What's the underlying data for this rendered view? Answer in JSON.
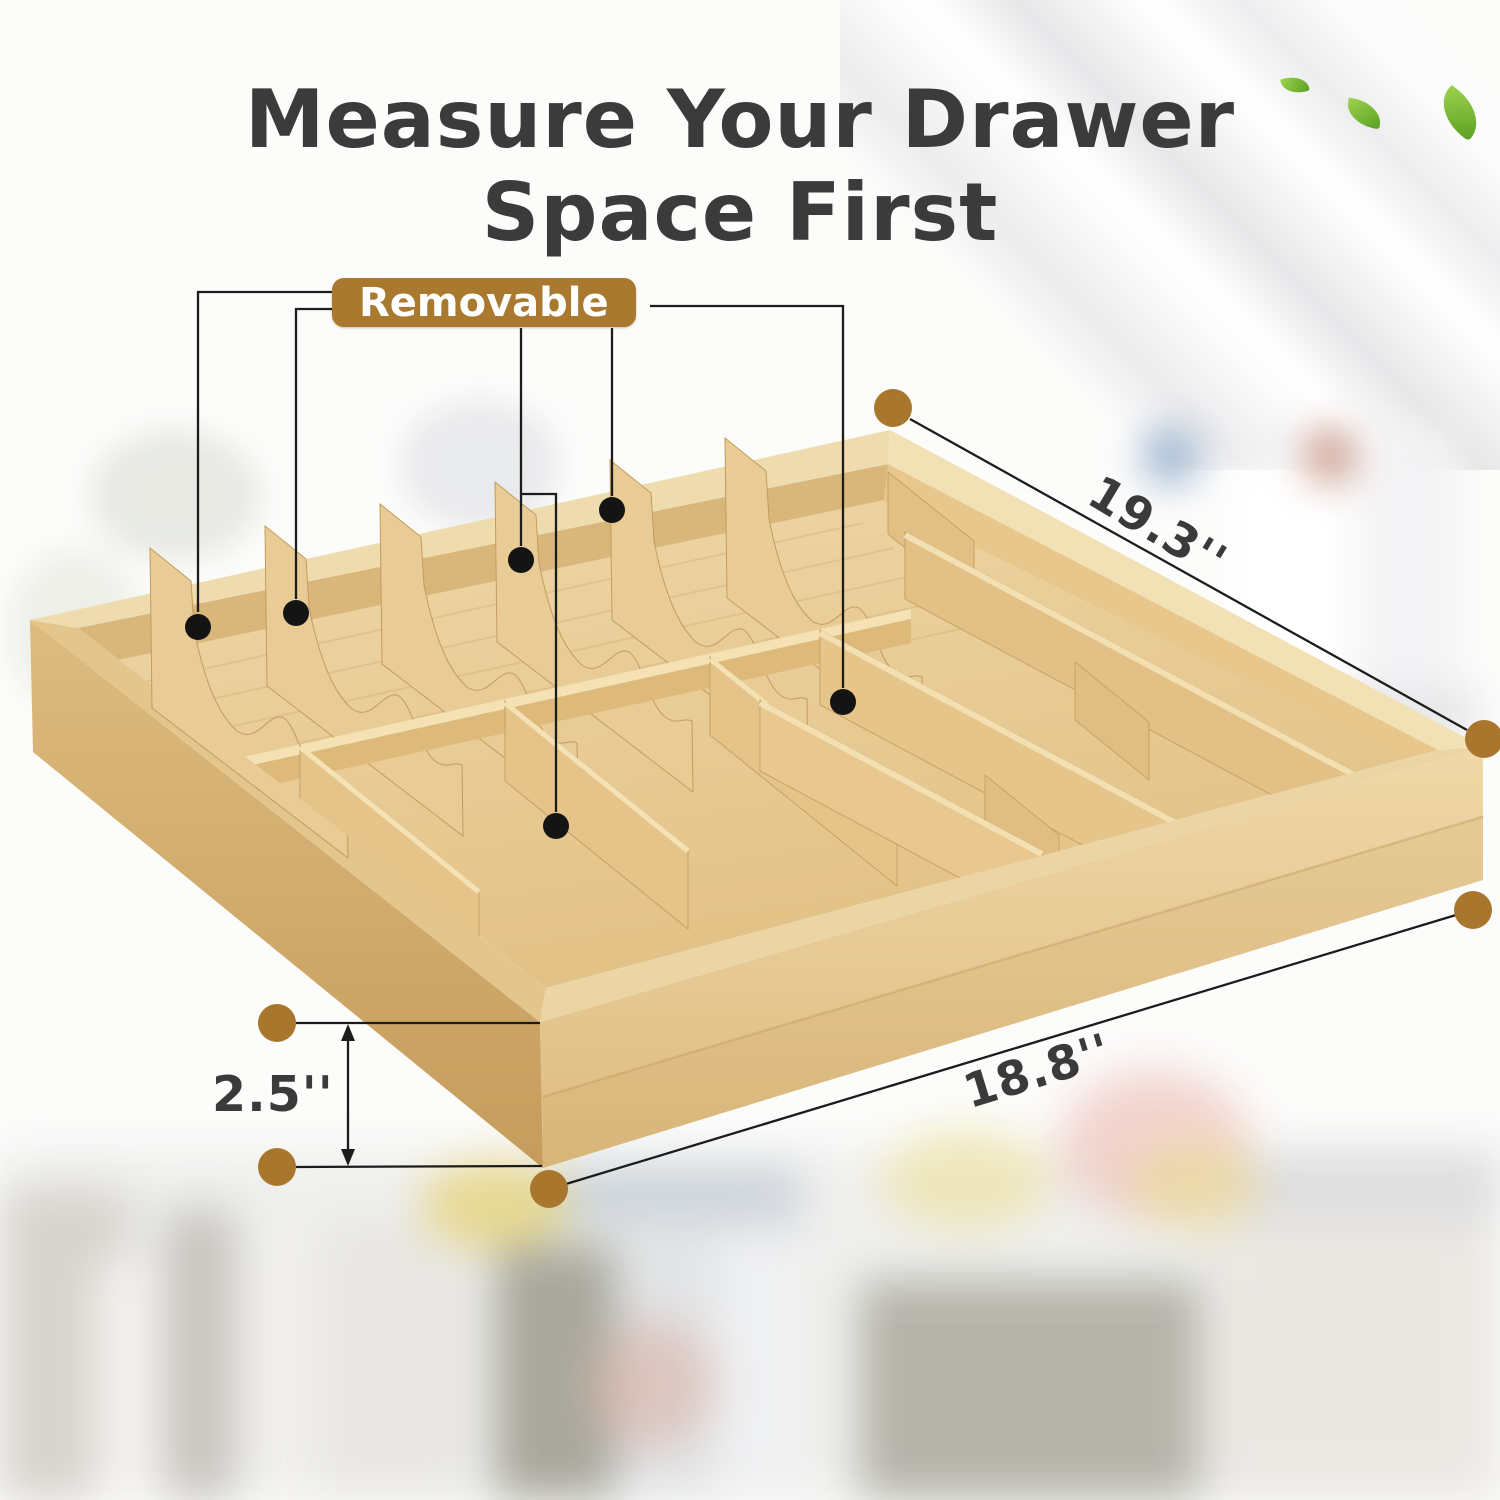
{
  "title": {
    "line1": "Measure Your Drawer",
    "line2": "Space First"
  },
  "callout": {
    "label": "Removable"
  },
  "dimensions": {
    "top_width": {
      "label": "19.3''"
    },
    "front_width": {
      "label": "18.8''"
    },
    "height": {
      "label": "2.5''"
    }
  },
  "icons": {
    "leaf": "leaf-shape (green crescent)"
  },
  "colors": {
    "accent_brown": "#a8792e",
    "gold_dot": "#a8762c",
    "callout_line": "#1c1c1c",
    "black_dot": "#141414",
    "title_text": "#3b3b3b",
    "dimension_text": "#3a3a3a",
    "bamboo_light": "#f0dcae",
    "bamboo_mid": "#e6c78e",
    "bamboo_dark": "#c9a263",
    "leaf_green": "#7cbd3a"
  }
}
